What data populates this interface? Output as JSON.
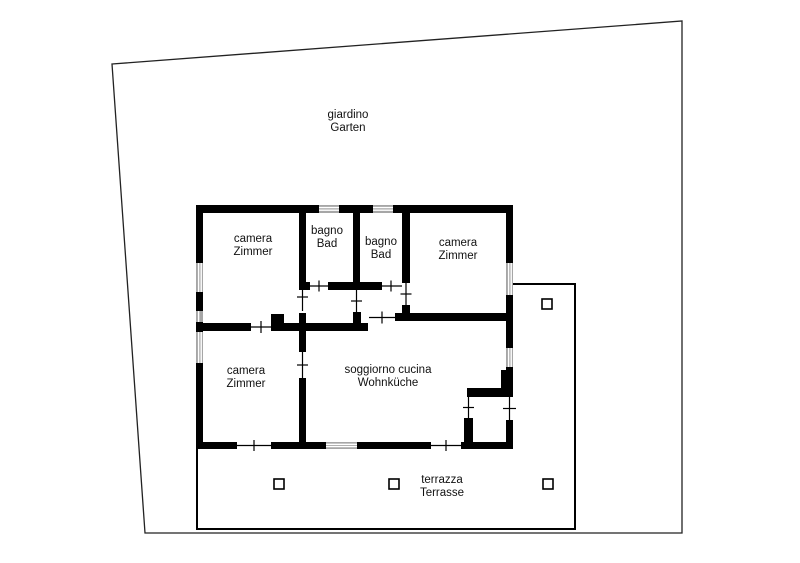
{
  "plan": {
    "garden": {
      "it": "giardino",
      "de": "Garten"
    },
    "rooms": {
      "bedroom_top_left": {
        "it": "camera",
        "de": "Zimmer"
      },
      "bath_left": {
        "it": "bagno",
        "de": "Bad"
      },
      "bath_right": {
        "it": "bagno",
        "de": "Bad"
      },
      "bedroom_top_right": {
        "it": "camera",
        "de": "Zimmer"
      },
      "bedroom_bottom_left": {
        "it": "camera",
        "de": "Zimmer"
      },
      "living_kitchen": {
        "it": "soggiorno cucina",
        "de": "Wohnküche"
      }
    },
    "terrace": {
      "it": "terrazza",
      "de": "Terrasse",
      "pillar_count": 4
    },
    "colors": {
      "wall": "#000000",
      "window_fill": "#a6a6a6",
      "boundary_line": "#222222",
      "background": "#ffffff",
      "text": "#111111"
    }
  }
}
